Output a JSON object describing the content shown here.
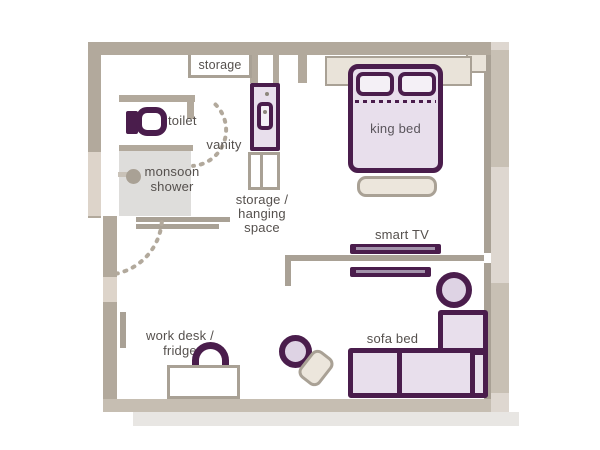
{
  "plan": {
    "title": "hotel room floor plan",
    "labels": {
      "storage": "storage",
      "toilet": "toilet",
      "monsoon_shower": [
        "monsoon",
        "shower"
      ],
      "vanity": "vanity",
      "hanging": [
        "storage /",
        "hanging",
        "space"
      ],
      "king_bed": "king bed",
      "smart_tv": "smart TV",
      "sofa_bed": "sofa bed",
      "work_desk": [
        "work desk /",
        "fridge"
      ]
    },
    "colors": {
      "wall": "#b2a99c",
      "wall_thin": "#a9a195",
      "wall_mid": "#c8c0b4",
      "wall_light": "#ddd4ca",
      "band_light": "#ded7d0",
      "bottom_wall": "#c6beb2",
      "shadow": "#e8e6e3",
      "shower_floor": "#dedddb",
      "accent": "#4a1d4c",
      "accent_fill": "#e8dfec",
      "accent_fill_light": "#f4f0f6",
      "accent_stripe": "#a393ab",
      "beige_fill": "#ece6dc",
      "headboard_fill": "#e9e3d9",
      "text": "#55504d"
    }
  }
}
